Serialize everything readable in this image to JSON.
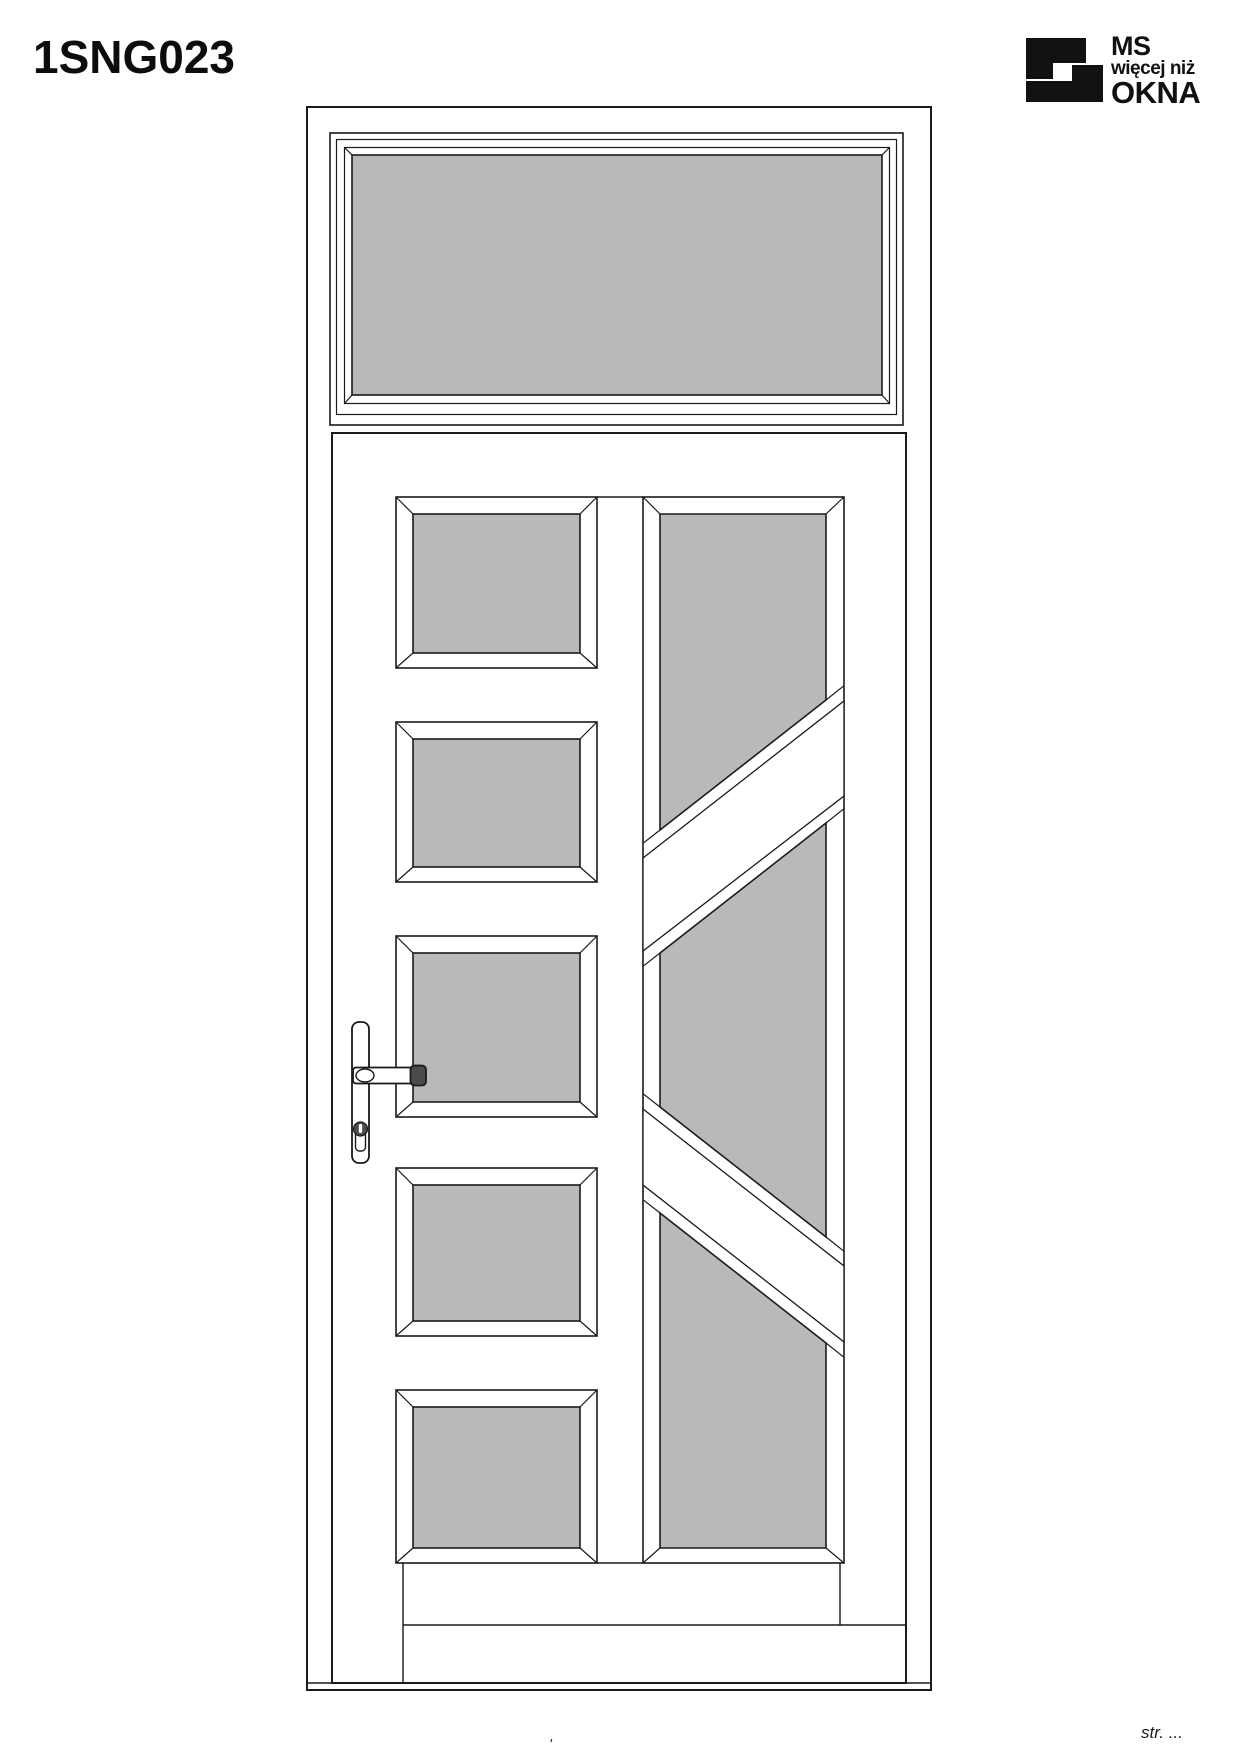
{
  "page": {
    "title": "1SNG023",
    "footer_page_label": "str. ...",
    "bottom_mark": "'",
    "background": "#ffffff"
  },
  "logo": {
    "line1": "MS",
    "line2": "więcej niż",
    "line3": "OKNA",
    "color": "#111111"
  },
  "drawing": {
    "type": "door-elevation",
    "model": "1SNG023",
    "glass_color": "#b9b9b9",
    "frame_color": "#ffffff",
    "line_color": "#1a1a1a",
    "handle_cap_color": "#4b4b4b",
    "transom_lights": 1,
    "left_column_panes": 5,
    "right_column_panes": 3
  }
}
